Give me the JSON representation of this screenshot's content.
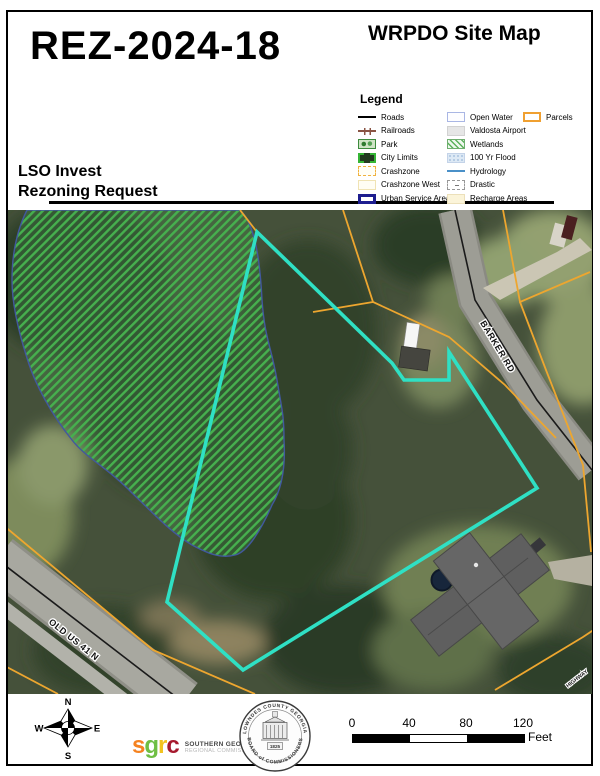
{
  "header": {
    "case_number": "REZ-2024-18",
    "map_title": "WRPDO Site Map"
  },
  "request": {
    "line1": "LSO Invest",
    "line2": "Rezoning Request"
  },
  "legend": {
    "title": "Legend",
    "columns": [
      [
        {
          "type": "roads",
          "label": "Roads"
        },
        {
          "type": "railroads",
          "label": "Railroads"
        },
        {
          "type": "park",
          "label": "Park"
        },
        {
          "type": "citylimits",
          "label": "City Limits"
        },
        {
          "type": "crashzone",
          "label": "Crashzone"
        },
        {
          "type": "crashzonewest",
          "label": "Crashzone West"
        },
        {
          "type": "urban",
          "label": "Urban Service Area"
        }
      ],
      [
        {
          "type": "openwater",
          "label": "Open Water"
        },
        {
          "type": "airport",
          "label": "Valdosta Airport"
        },
        {
          "type": "wetlands",
          "label": "Wetlands"
        },
        {
          "type": "flood",
          "label": "100 Yr Flood"
        },
        {
          "type": "hydrology",
          "label": "Hydrology"
        },
        {
          "type": "drastic",
          "label": "Drastic"
        },
        {
          "type": "recharge",
          "label": "Recharge Areas"
        }
      ],
      [
        {
          "type": "parcels",
          "label": "Parcels"
        }
      ]
    ]
  },
  "map": {
    "labels": {
      "barker": "BARKER RD",
      "old41": "OLD US 41 N",
      "corner": "HIGHWAY"
    }
  },
  "compass": {
    "n": "N",
    "e": "E",
    "s": "S",
    "w": "W"
  },
  "logos": {
    "sgrc": {
      "letters": [
        "s",
        "g",
        "r",
        "c"
      ],
      "line1": "SOUTHERN GEORGIA",
      "line2": "REGIONAL COMMISSION"
    },
    "seal": {
      "top": "LOWNDES COUNTY GEORGIA",
      "bottom": "BOARD of COMMISSIONERS",
      "year": "1825"
    }
  },
  "scalebar": {
    "ticks": [
      "0",
      "40",
      "80",
      "120"
    ],
    "unit": "Feet"
  },
  "colors": {
    "parcel_highlight": "#2fe0c4",
    "parcel_lines": "#eda62f",
    "wetland_hatch": "#46b04e",
    "sgrc_s": "#f58220",
    "sgrc_g": "#6fbe44",
    "sgrc_r": "#f2c31f",
    "sgrc_c": "#a6192e"
  }
}
